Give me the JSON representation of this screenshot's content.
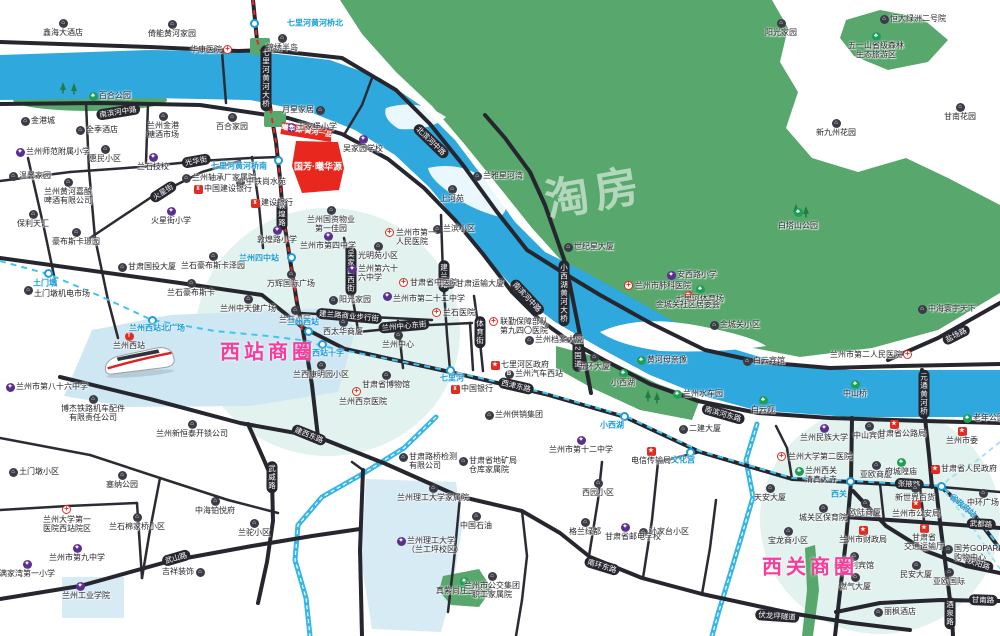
{
  "watermark": "淘房",
  "project": {
    "banner_label": "曦华源·黄河一品",
    "block_label": "国芳·曦华源"
  },
  "colors": {
    "river": "#2fa8de",
    "green": "#58a76c",
    "road": "#26262e",
    "metro_line": "#40c4f5",
    "metro_construction": "#e8281e",
    "highlight_red": "#e8281e",
    "circle_text": "#f83c9e"
  },
  "business_circles": [
    {
      "label": "西站商圈",
      "x": 268,
      "y": 350
    },
    {
      "label": "西关商圈",
      "x": 810,
      "y": 565
    }
  ],
  "metro": {
    "stations": [
      [
        254,
        23
      ],
      [
        278,
        160
      ],
      [
        291,
        257
      ],
      [
        48,
        273
      ],
      [
        152,
        320
      ],
      [
        308,
        331
      ],
      [
        322,
        344
      ],
      [
        450,
        370
      ],
      [
        624,
        416
      ],
      [
        690,
        452
      ],
      [
        850,
        481
      ],
      [
        941,
        486
      ]
    ],
    "labels": [
      {
        "l": "七里河黄河桥北",
        "x": 282,
        "y": 23,
        "a": "l"
      },
      {
        "l": "七里河黄河桥南",
        "x": 272,
        "y": 166,
        "a": "r"
      },
      {
        "l": "兰州四中站",
        "x": 284,
        "y": 258,
        "a": "r"
      },
      {
        "l": "土门墩",
        "x": 45,
        "y": 283,
        "a": "c"
      },
      {
        "l": "兰州西站北广场",
        "x": 157,
        "y": 328,
        "a": "c"
      },
      {
        "l": "兰州西站",
        "x": 303,
        "y": 322,
        "a": "c"
      },
      {
        "l": "西站十字",
        "x": 328,
        "y": 353,
        "a": "c"
      },
      {
        "l": "七里河",
        "x": 452,
        "y": 378,
        "a": "c"
      },
      {
        "l": "小西湖",
        "x": 612,
        "y": 425,
        "a": "c"
      },
      {
        "l": "文化宫",
        "x": 683,
        "y": 460,
        "a": "c"
      },
      {
        "l": "西关",
        "x": 839,
        "y": 494,
        "a": "c"
      },
      {
        "l": "省政府站",
        "x": 963,
        "y": 506,
        "a": "c",
        "rot": 40
      }
    ]
  },
  "road_labels": [
    {
      "l": "南滨河中路",
      "x": 118,
      "y": 112,
      "rot": -9
    },
    {
      "l": "北滨河中路",
      "x": 431,
      "y": 141,
      "rot": 44
    },
    {
      "l": "七里河黄河大桥",
      "x": 266,
      "y": 78,
      "v": 1
    },
    {
      "l": "敦煌路",
      "x": 282,
      "y": 214,
      "v": 1
    },
    {
      "l": "吴家园西街",
      "x": 351,
      "y": 271,
      "v": 1
    },
    {
      "l": "建兰路",
      "x": 444,
      "y": 276,
      "v": 1
    },
    {
      "l": "光华街",
      "x": 196,
      "y": 161,
      "rot": -10
    },
    {
      "l": "火星街",
      "x": 163,
      "y": 192,
      "rot": -33
    },
    {
      "l": "建兰路商业步行街",
      "x": 349,
      "y": 316,
      "rot": 5
    },
    {
      "l": "兰州中心东街",
      "x": 404,
      "y": 326,
      "rot": -5
    },
    {
      "l": "体育街",
      "x": 480,
      "y": 332,
      "v": 1
    },
    {
      "l": "小西湖黄河大桥",
      "x": 564,
      "y": 293,
      "v": 1
    },
    {
      "l": "312国道",
      "x": 578,
      "y": 352,
      "v": 1
    },
    {
      "l": "西津东路",
      "x": 516,
      "y": 386,
      "rot": 13
    },
    {
      "l": "建西东路",
      "x": 309,
      "y": 435,
      "rot": 22
    },
    {
      "l": "南滨河中路",
      "x": 527,
      "y": 297,
      "rot": 47
    },
    {
      "l": "南滨河东路",
      "x": 723,
      "y": 414,
      "rot": 16
    },
    {
      "l": "盐场路",
      "x": 956,
      "y": 335,
      "rot": -27
    },
    {
      "l": "元通黄河桥",
      "x": 924,
      "y": 394,
      "v": 1
    },
    {
      "l": "张掖路",
      "x": 909,
      "y": 484,
      "rot": 3
    },
    {
      "l": "武都路",
      "x": 981,
      "y": 524,
      "rot": 3
    },
    {
      "l": "庆阳路",
      "x": 979,
      "y": 564,
      "rot": 17
    },
    {
      "l": "甘南路",
      "x": 983,
      "y": 600,
      "rot": 2
    },
    {
      "l": "酒泉路",
      "x": 950,
      "y": 613,
      "v": 1
    },
    {
      "l": "伏龙坪隧道",
      "x": 777,
      "y": 616,
      "rot": 4
    },
    {
      "l": "武威路",
      "x": 272,
      "y": 477,
      "v": 1
    },
    {
      "l": "武山路",
      "x": 176,
      "y": 558,
      "rot": -16
    },
    {
      "l": "南环东路",
      "x": 602,
      "y": 566,
      "rot": 17
    }
  ],
  "pois": [
    {
      "t": "g",
      "x": 63,
      "y": 23,
      "a": "b",
      "l": "鑫海大酒店"
    },
    {
      "t": "g",
      "x": 172,
      "y": 24,
      "a": "b",
      "l": "倚能黄河家园"
    },
    {
      "t": "h",
      "x": 228,
      "y": 50,
      "a": "l",
      "l": "华康医院"
    },
    {
      "t": "g",
      "x": 282,
      "y": 38,
      "a": "b",
      "l": "锦绣半岛"
    },
    {
      "t": "g",
      "x": 25,
      "y": 121,
      "a": "r",
      "l": "金港城"
    },
    {
      "t": "g",
      "x": 80,
      "y": 130,
      "a": "r",
      "l": "全季酒店"
    },
    {
      "t": "g",
      "x": 163,
      "y": 116,
      "a": "b",
      "l": "兰州金港\n糖酒市场"
    },
    {
      "t": "g",
      "x": 232,
      "y": 117,
      "a": "b",
      "l": "百合家园"
    },
    {
      "t": "g",
      "x": 320,
      "y": 110,
      "a": "l",
      "l": "月星家居"
    },
    {
      "t": "s",
      "x": 291,
      "y": 127,
      "a": "r",
      "l": "王家堡小学"
    },
    {
      "t": "s",
      "x": 20,
      "y": 152,
      "a": "r",
      "l": "兰州师范附属小学"
    },
    {
      "t": "g",
      "x": 105,
      "y": 149,
      "a": "b",
      "l": "惠民小区"
    },
    {
      "t": "g",
      "x": 13,
      "y": 176,
      "a": "r",
      "l": "温馨家园"
    },
    {
      "t": "g",
      "x": 68,
      "y": 182,
      "a": "b",
      "l": "兰州黄河嘉酿\n啤酒有限公司"
    },
    {
      "t": "g",
      "x": 186,
      "y": 178,
      "a": "r",
      "l": "兰州轴承厂家属院"
    },
    {
      "t": "bk",
      "x": 198,
      "y": 189,
      "a": "r",
      "l": "中国建设银行"
    },
    {
      "t": "s",
      "x": 153,
      "y": 157,
      "a": "b",
      "l": "兰石技校"
    },
    {
      "t": "s",
      "x": 171,
      "y": 211,
      "a": "b",
      "l": "火星街小学"
    },
    {
      "t": "g",
      "x": 33,
      "y": 214,
      "a": "b",
      "l": "保利天汇"
    },
    {
      "t": "g",
      "x": 76,
      "y": 232,
      "a": "b",
      "l": "豪布斯卡璟园"
    },
    {
      "t": "g",
      "x": 122,
      "y": 267,
      "a": "r",
      "l": "甘肃国投大厦"
    },
    {
      "t": "g",
      "x": 213,
      "y": 256,
      "a": "b",
      "l": "兰石豪布斯卡泽园"
    },
    {
      "t": "g",
      "x": 191,
      "y": 283,
      "a": "b",
      "l": "兰石豪布斯卡"
    },
    {
      "t": "g",
      "x": 28,
      "y": 290,
      "a": "r",
      "l": "土门墩机电市场",
      "oy": 4
    },
    {
      "t": "t",
      "x": 129,
      "y": 336,
      "a": "b",
      "l": "兰州西站"
    },
    {
      "t": "g",
      "x": 93,
      "y": 399,
      "a": "b",
      "l": "博杰铁路机车配件\n有限责任公司"
    },
    {
      "t": "g",
      "x": 192,
      "y": 424,
      "a": "b",
      "l": "兰州新恒泰开锁公司"
    },
    {
      "t": "g",
      "x": 13,
      "y": 472,
      "a": "r",
      "l": "土门墩小区"
    },
    {
      "t": "g",
      "x": 122,
      "y": 475,
      "a": "b",
      "l": "塞纳公园"
    },
    {
      "t": "h",
      "x": 67,
      "y": 510,
      "a": "b",
      "l": "兰州大学第一\n医院西站院区"
    },
    {
      "t": "g",
      "x": 137,
      "y": 517,
      "a": "b",
      "l": "兰石棉家桥小区"
    },
    {
      "t": "g",
      "x": 215,
      "y": 501,
      "a": "b",
      "l": "中海铂悦府"
    },
    {
      "t": "g",
      "x": 254,
      "y": 523,
      "a": "b",
      "l": "兰驼小区"
    },
    {
      "t": "s",
      "x": 27,
      "y": 564,
      "a": "b",
      "l": "满家湾第一小学"
    },
    {
      "t": "s",
      "x": 77,
      "y": 548,
      "a": "b",
      "l": "兰州市第九中学"
    },
    {
      "t": "s",
      "x": 80,
      "y": 586,
      "a": "b",
      "l": "兰州工业学院",
      "ox": 6
    },
    {
      "t": "g",
      "x": 200,
      "y": 572,
      "a": "l",
      "l": "吉祥装饰"
    },
    {
      "t": "s",
      "x": 10,
      "y": 387,
      "a": "r",
      "l": "兰州市第八十六中学"
    },
    {
      "t": "s",
      "x": 363,
      "y": 139,
      "a": "b",
      "l": "吴家园学校"
    },
    {
      "t": "g",
      "x": 240,
      "y": 182,
      "a": "r",
      "l": "中铁尚水苑"
    },
    {
      "t": "bk",
      "x": 255,
      "y": 203,
      "a": "r",
      "l": "建设银行"
    },
    {
      "t": "g",
      "x": 331,
      "y": 210,
      "a": "b",
      "l": "兰州国资物业\n第一佳园"
    },
    {
      "t": "s",
      "x": 277,
      "y": 230,
      "a": "b",
      "l": "敦煌路小学"
    },
    {
      "t": "s",
      "x": 328,
      "y": 236,
      "a": "b",
      "l": "兰州市第四中学"
    },
    {
      "t": "g",
      "x": 378,
      "y": 246,
      "a": "b",
      "l": "光明苑小区"
    },
    {
      "t": "s",
      "x": 352,
      "y": 269,
      "a": "r",
      "l": "兰州第六十\n六中学"
    },
    {
      "t": "g",
      "x": 291,
      "y": 274,
      "a": "b",
      "l": "万辉国际广场"
    },
    {
      "t": "g",
      "x": 248,
      "y": 299,
      "a": "b",
      "l": "兰州中天健广场"
    },
    {
      "t": "g",
      "x": 295,
      "y": 310,
      "a": "b",
      "l": "兰石小区"
    },
    {
      "t": "g",
      "x": 333,
      "y": 300,
      "a": "r",
      "l": "阳光家园"
    },
    {
      "t": "s",
      "x": 387,
      "y": 296,
      "a": "r",
      "l": "兰州市第二十二中学",
      "oy": 3
    },
    {
      "t": "h",
      "x": 404,
      "y": 283,
      "a": "r",
      "l": "甘肃省中医院"
    },
    {
      "t": "h",
      "x": 437,
      "y": 313,
      "a": "r",
      "l": "兰石医院"
    },
    {
      "t": "g",
      "x": 343,
      "y": 322,
      "a": "b",
      "l": "西太华商厦"
    },
    {
      "t": "g",
      "x": 398,
      "y": 335,
      "a": "b",
      "l": "兰州中心"
    },
    {
      "t": "g",
      "x": 452,
      "y": 189,
      "a": "b",
      "l": "上河苑"
    },
    {
      "t": "h",
      "x": 390,
      "y": 233,
      "a": "r",
      "l": "兰州市第一\n人民医院"
    },
    {
      "t": "g",
      "x": 437,
      "y": 229,
      "a": "r",
      "l": "兰滨小区"
    },
    {
      "t": "g",
      "x": 568,
      "y": 247,
      "a": "r",
      "l": "世纪星大厦"
    },
    {
      "t": "g",
      "x": 477,
      "y": 176,
      "a": "r",
      "l": "兰雅星河湾"
    },
    {
      "t": "g",
      "x": 450,
      "y": 284,
      "a": "r",
      "l": "甘肃运输大厦"
    },
    {
      "t": "s",
      "x": 671,
      "y": 275,
      "a": "r",
      "l": "安西路小学"
    },
    {
      "t": "p",
      "x": 700,
      "y": 289,
      "a": "b",
      "l": "七里河体育场"
    },
    {
      "t": "h",
      "x": 494,
      "y": 322,
      "a": "r",
      "l": "联勤保障部队\n第九四〇医院"
    },
    {
      "t": "g",
      "x": 529,
      "y": 340,
      "a": "r",
      "l": "兰州档案大厦"
    },
    {
      "t": "gv",
      "x": 495,
      "y": 365,
      "a": "r",
      "l": "七里河区政府"
    },
    {
      "t": "u",
      "x": 509,
      "y": 374,
      "a": "r",
      "l": "兰州汽车西站"
    },
    {
      "t": "g",
      "x": 594,
      "y": 357,
      "a": "b",
      "l": "五环大厦"
    },
    {
      "t": "p",
      "x": 641,
      "y": 360,
      "a": "r",
      "l": "黄河母亲像"
    },
    {
      "t": "p",
      "x": 623,
      "y": 373,
      "a": "b",
      "l": "小西湖"
    },
    {
      "t": "p",
      "x": 677,
      "y": 394,
      "a": "r",
      "l": "兰州水车园"
    },
    {
      "t": "p",
      "x": 763,
      "y": 400,
      "a": "b",
      "l": "白云观"
    },
    {
      "t": "g",
      "x": 714,
      "y": 325,
      "a": "r",
      "l": "金城关小区"
    },
    {
      "t": "st",
      "x": 688,
      "y": 295,
      "a": "b",
      "l": "金城关社区居委会"
    },
    {
      "t": "h",
      "x": 629,
      "y": 286,
      "a": "r",
      "l": "兰州市肺科医院"
    },
    {
      "t": "g",
      "x": 922,
      "y": 309,
      "a": "r",
      "l": "中海寰宇天下"
    },
    {
      "t": "h",
      "x": 908,
      "y": 355,
      "a": "l",
      "l": "兰州市第二人民医院"
    },
    {
      "t": "g",
      "x": 747,
      "y": 361,
      "a": "r",
      "l": "白云宾馆"
    },
    {
      "t": "p",
      "x": 855,
      "y": 384,
      "a": "b",
      "l": "中山桥"
    },
    {
      "t": "p",
      "x": 967,
      "y": 418,
      "a": "r",
      "l": "老年公园"
    },
    {
      "t": "s",
      "x": 824,
      "y": 428,
      "a": "b",
      "l": "兰州民族大学"
    },
    {
      "t": "g",
      "x": 869,
      "y": 426,
      "a": "b",
      "l": "中山宾馆"
    },
    {
      "t": "gv",
      "x": 894,
      "y": 424,
      "a": "b",
      "l": "甘肃省公路局",
      "ox": 8
    },
    {
      "t": "gv",
      "x": 962,
      "y": 431,
      "a": "b",
      "l": "兰州市委"
    },
    {
      "t": "h",
      "x": 782,
      "y": 457,
      "a": "r",
      "l": "兰州大学第二医院"
    },
    {
      "t": "p",
      "x": 799,
      "y": 471,
      "a": "r",
      "l": "兰州西关\n清真大寺"
    },
    {
      "t": "g",
      "x": 770,
      "y": 488,
      "a": "b",
      "l": "天安大厦"
    },
    {
      "t": "g",
      "x": 876,
      "y": 465,
      "a": "b",
      "l": "亚欧商厦"
    },
    {
      "t": "p",
      "x": 901,
      "y": 462,
      "a": "b",
      "l": "府城隍庙"
    },
    {
      "t": "gv",
      "x": 935,
      "y": 469,
      "a": "r",
      "l": "甘肃省人民政府"
    },
    {
      "t": "g",
      "x": 865,
      "y": 503,
      "a": "b",
      "l": "欧陆商厦"
    },
    {
      "t": "g",
      "x": 915,
      "y": 488,
      "a": "b",
      "l": "新世界百货"
    },
    {
      "t": "gv",
      "x": 916,
      "y": 504,
      "a": "b",
      "l": "兰州市公安局"
    },
    {
      "t": "g",
      "x": 983,
      "y": 493,
      "a": "b",
      "l": "中环广场"
    },
    {
      "t": "g",
      "x": 823,
      "y": 508,
      "a": "b",
      "l": "城关区保育院"
    },
    {
      "t": "g",
      "x": 788,
      "y": 531,
      "a": "b",
      "l": "宝龙商小区"
    },
    {
      "t": "gv",
      "x": 863,
      "y": 530,
      "a": "b",
      "l": "兰州市财政局"
    },
    {
      "t": "gv",
      "x": 924,
      "y": 528,
      "a": "b",
      "l": "甘肃省\n交通运输厅"
    },
    {
      "t": "g",
      "x": 948,
      "y": 549,
      "a": "r",
      "l": "国芳GOPARK\n购物中心"
    },
    {
      "t": "g",
      "x": 854,
      "y": 556,
      "a": "b",
      "l": "新胜利宾馆"
    },
    {
      "t": "g",
      "x": 916,
      "y": 565,
      "a": "b",
      "l": "民安大厦"
    },
    {
      "t": "g",
      "x": 949,
      "y": 572,
      "a": "b",
      "l": "亚欧国际"
    },
    {
      "t": "g",
      "x": 855,
      "y": 577,
      "a": "b",
      "l": "燃气大厦"
    },
    {
      "t": "g",
      "x": 878,
      "y": 612,
      "a": "r",
      "l": "丽枫酒店"
    },
    {
      "t": "g",
      "x": 643,
      "y": 532,
      "a": "r",
      "l": "孙家台小区"
    },
    {
      "t": "g",
      "x": 683,
      "y": 429,
      "a": "r",
      "l": "二建大厦"
    },
    {
      "t": "g",
      "x": 489,
      "y": 415,
      "a": "r",
      "l": "兰州供销集团"
    },
    {
      "t": "g",
      "x": 386,
      "y": 375,
      "a": "b",
      "l": "甘肃省博物馆"
    },
    {
      "t": "h",
      "x": 357,
      "y": 392,
      "a": "b",
      "l": "兰州西京医院",
      "ox": 6
    },
    {
      "t": "g",
      "x": 321,
      "y": 365,
      "a": "b",
      "l": "兰西康明园小区"
    },
    {
      "t": "g",
      "x": 403,
      "y": 457,
      "a": "r",
      "l": "甘肃路桥检测\n有限公司"
    },
    {
      "t": "g",
      "x": 463,
      "y": 461,
      "a": "r",
      "l": "甘肃省地矿局\n仓库家属院"
    },
    {
      "t": "s",
      "x": 581,
      "y": 440,
      "a": "b",
      "l": "兰州市第十二中学"
    },
    {
      "t": "gv",
      "x": 651,
      "y": 451,
      "a": "b",
      "l": "电信传输局"
    },
    {
      "t": "g",
      "x": 433,
      "y": 488,
      "a": "b",
      "l": "兰州理工大学家属院"
    },
    {
      "t": "g",
      "x": 598,
      "y": 483,
      "a": "b",
      "l": "西园小区"
    },
    {
      "t": "g",
      "x": 476,
      "y": 516,
      "a": "b",
      "l": "中国石油"
    },
    {
      "t": "g",
      "x": 585,
      "y": 522,
      "a": "b",
      "l": "格兰绿都"
    },
    {
      "t": "s",
      "x": 625,
      "y": 527,
      "a": "b",
      "l": "甘肃省邮电学校",
      "ox": 8
    },
    {
      "t": "s",
      "x": 401,
      "y": 541,
      "a": "r",
      "l": "兰州理工大学\n（兰工坪校区）"
    },
    {
      "t": "p",
      "x": 464,
      "y": 581,
      "a": "b",
      "l": "真紫尚庄生态园"
    },
    {
      "t": "g",
      "x": 492,
      "y": 576,
      "a": "b",
      "l": "兰州市公交集团\n职工家属院"
    },
    {
      "t": "bk",
      "x": 455,
      "y": 389,
      "a": "r",
      "l": "中国银行"
    },
    {
      "t": "p",
      "x": 876,
      "y": 36,
      "a": "b",
      "l": "五一山省级森林\n生态旅游区"
    },
    {
      "t": "p2",
      "x": 798,
      "y": 212,
      "a": "b",
      "l": "白塔山公园",
      "oy": 4
    },
    {
      "t": "g",
      "x": 781,
      "y": 23,
      "a": "b",
      "l": "阳光家园"
    },
    {
      "t": "g",
      "x": 884,
      "y": 19,
      "a": "r",
      "l": "恒大绿洲二号院"
    },
    {
      "t": "g",
      "x": 836,
      "y": 123,
      "a": "b",
      "l": "新九州花园"
    },
    {
      "t": "g",
      "x": 960,
      "y": 107,
      "a": "b",
      "l": "甘南花园"
    },
    {
      "t": "p",
      "x": 93,
      "y": 96,
      "a": "r",
      "l": "百合公园"
    }
  ]
}
